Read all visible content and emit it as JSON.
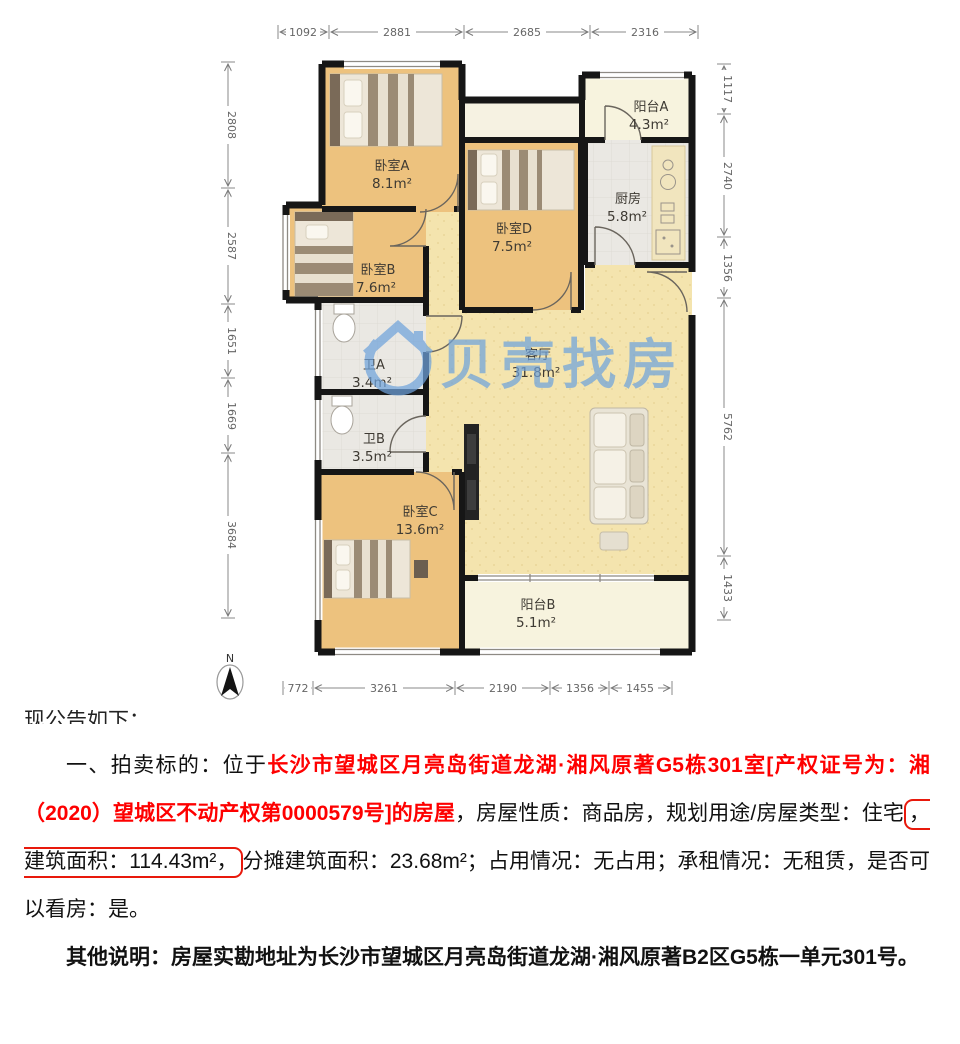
{
  "floorplan": {
    "watermark": "贝壳找房",
    "north_label": "N",
    "rooms": [
      {
        "name": "卧室A",
        "area": "8.1m²"
      },
      {
        "name": "卧室B",
        "area": "7.6m²"
      },
      {
        "name": "卧室C",
        "area": "13.6m²"
      },
      {
        "name": "卧室D",
        "area": "7.5m²"
      },
      {
        "name": "卫A",
        "area": "3.4m²"
      },
      {
        "name": "卫B",
        "area": "3.5m²"
      },
      {
        "name": "厨房",
        "area": "5.8m²"
      },
      {
        "name": "客厅",
        "area": "31.8m²"
      },
      {
        "name": "阳台A",
        "area": "4.3m²"
      },
      {
        "name": "阳台B",
        "area": "5.1m²"
      }
    ],
    "dimensions": {
      "top": [
        "1092",
        "2881",
        "2685",
        "2316"
      ],
      "bottom": [
        "772",
        "3261",
        "2190",
        "1356",
        "1455"
      ],
      "left": [
        "2808",
        "2587",
        "1651",
        "1669",
        "3684"
      ],
      "right": [
        "1117",
        "2740",
        "1356",
        "5762",
        "1433"
      ]
    },
    "colors": {
      "watermark_blue": "#6fa3dc",
      "wood": "#edc27e",
      "living": "#f4e4ae",
      "tile": "#eae8e3",
      "balcony": "#f7f3de"
    }
  },
  "text_section": {
    "clipped_line": "现公告如下：",
    "paragraph1": {
      "lead": "一、拍卖标的：位于",
      "highlight": "长沙市望城区月亮岛街道龙湖·湘风原著G5栋301室[产权证号为：湘（2020）望城区不动产权第0000579号]的房屋",
      "mid": "，房屋性质：商品房，规划用途/房屋类型：住宅",
      "boxed": "，建筑面积：114.43m²，",
      "tail": "分摊建筑面积：23.68m²；占用情况：无占用；承租情况：无租赁，是否可以看房：是。"
    },
    "paragraph2": "其他说明：房屋实勘地址为长沙市望城区月亮岛街道龙湖·湘风原著B2区G5栋一单元301号。",
    "colors": {
      "highlight_red": "#fe0000",
      "box_red": "#e8190c"
    }
  }
}
